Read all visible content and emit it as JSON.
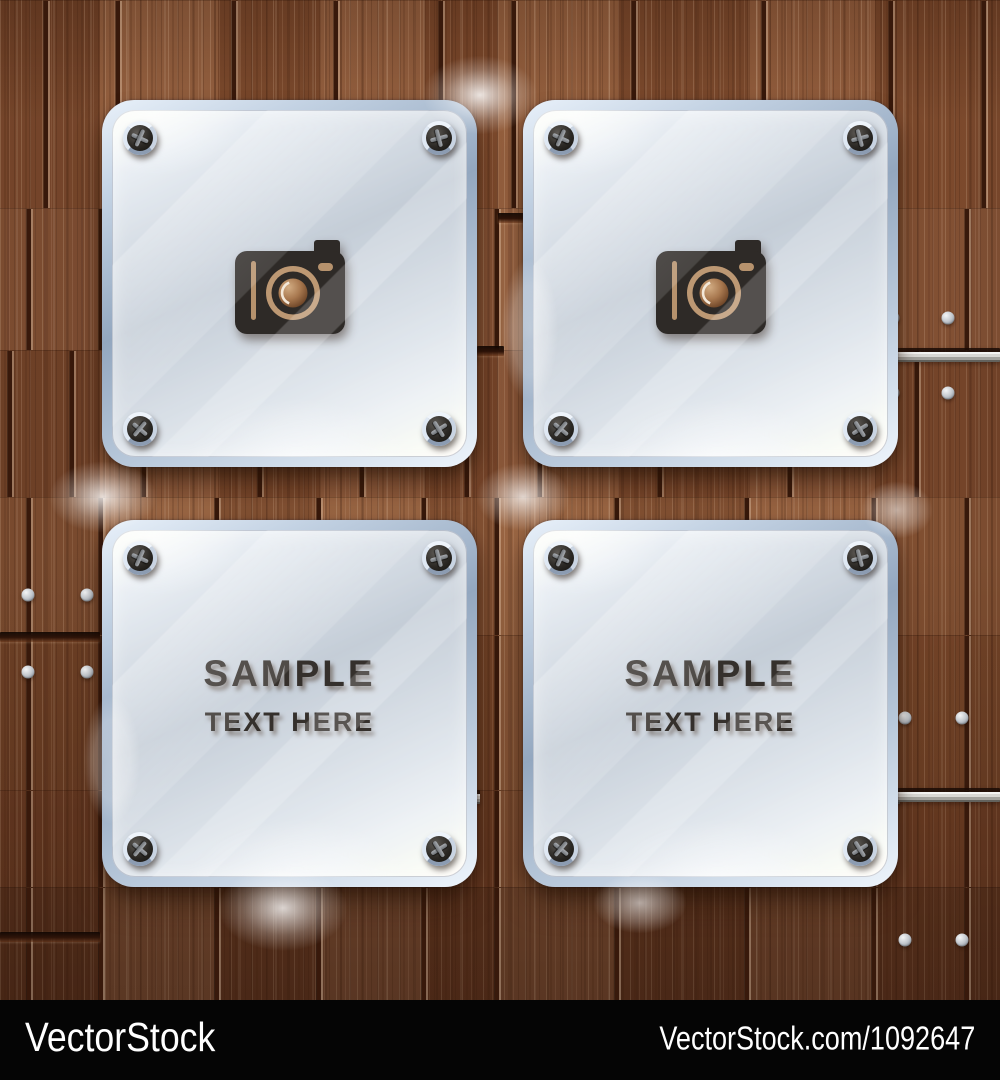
{
  "panels": [
    {
      "id": "top-left",
      "content": "icon",
      "icon": "camera-icon"
    },
    {
      "id": "top-right",
      "content": "icon",
      "icon": "camera-icon"
    },
    {
      "id": "bottom-left",
      "content": "text",
      "title": "SAMPLE",
      "subtitle": "TEXT HERE"
    },
    {
      "id": "bottom-right",
      "content": "text",
      "title": "SAMPLE",
      "subtitle": "TEXT HERE"
    }
  ],
  "watermark": {
    "brand": "VectorStock",
    "reference": "VectorStock.com/1092647",
    "bar_color": "#050505",
    "text_color": "#ffffff"
  },
  "colors": {
    "wood_base": "#8a5434",
    "wood_gap": "#38190b",
    "wood_under_glass": "#c8a483",
    "glass_frame_silver": "#b9c9db",
    "glass_tint": "rgba(255,243,229,0.36)",
    "icon_dark": "#2e2a27",
    "icon_cutout_tan": "#b6926d",
    "sample_text": "#35302c",
    "nail_silver": "#c7ccd1"
  }
}
